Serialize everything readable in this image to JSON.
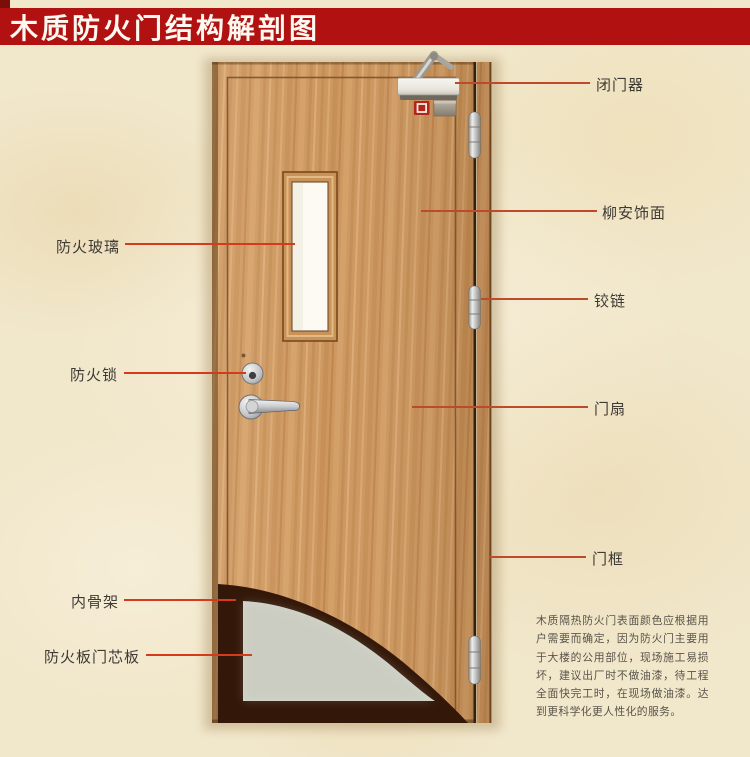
{
  "title": {
    "text": "木质防火门结构解剖图"
  },
  "colors": {
    "banner_red": "#b11111",
    "leader_left": "#d63a1c",
    "leader_right": "#bd4b2b",
    "wood": "#cd9760",
    "core_gray": "#d5d7cd",
    "inner_frame_dark": "#331708",
    "background_cream": "#f1e7cb"
  },
  "labels": {
    "right": [
      {
        "text": "闭门器"
      },
      {
        "text": "柳安饰面"
      },
      {
        "text": "铰链"
      },
      {
        "text": "门扇"
      },
      {
        "text": "门框"
      }
    ],
    "left": [
      {
        "text": "防火玻璃"
      },
      {
        "text": "防火锁"
      },
      {
        "text": "内骨架"
      },
      {
        "text": "防火板门芯板"
      }
    ]
  },
  "description": {
    "text": "木质隔热防火门表面颜色应根据用户需要而确定，因为防火门主要用于大楼的公用部位，现场施工易损坏，建议出厂时不做油漆，待工程全面快完工时，在现场做油漆。达到更科学化更人性化的服务。"
  }
}
